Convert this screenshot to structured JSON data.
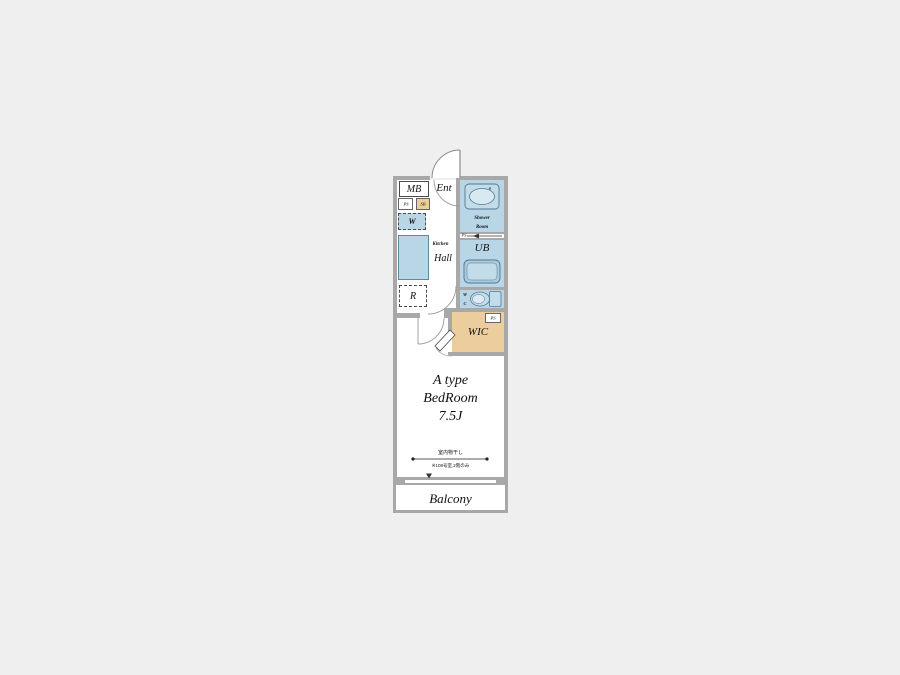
{
  "page": {
    "type": "floor-plan",
    "background_color": "#efefef"
  },
  "colors": {
    "wall_gray": "#a8a8a8",
    "wet_area_blue": "#b8d6e6",
    "fixture_blue": "#cfe3ee",
    "closet_tan": "#eccd9e",
    "text": "#111111"
  },
  "rooms": {
    "mb": "MB",
    "ent": "Ent",
    "ps1": "PS",
    "sb": "SB",
    "washer": "W",
    "kitchen": "Kitchen",
    "hall": "Hall",
    "fridge": "R",
    "shower_line1": "Shower",
    "shower_line2": "Room",
    "ps2": "PS",
    "ub": "UB",
    "wc_line1": "W",
    "wc_line2": "C",
    "ps3": "PS",
    "wic": "WIC",
    "bedroom_line1": "A type",
    "bedroom_line2": "BedRoom",
    "bedroom_line3": "7.5J",
    "note_line1": "室内物干し",
    "note_line2": "※108号室,2階のみ",
    "balcony": "Balcony"
  }
}
